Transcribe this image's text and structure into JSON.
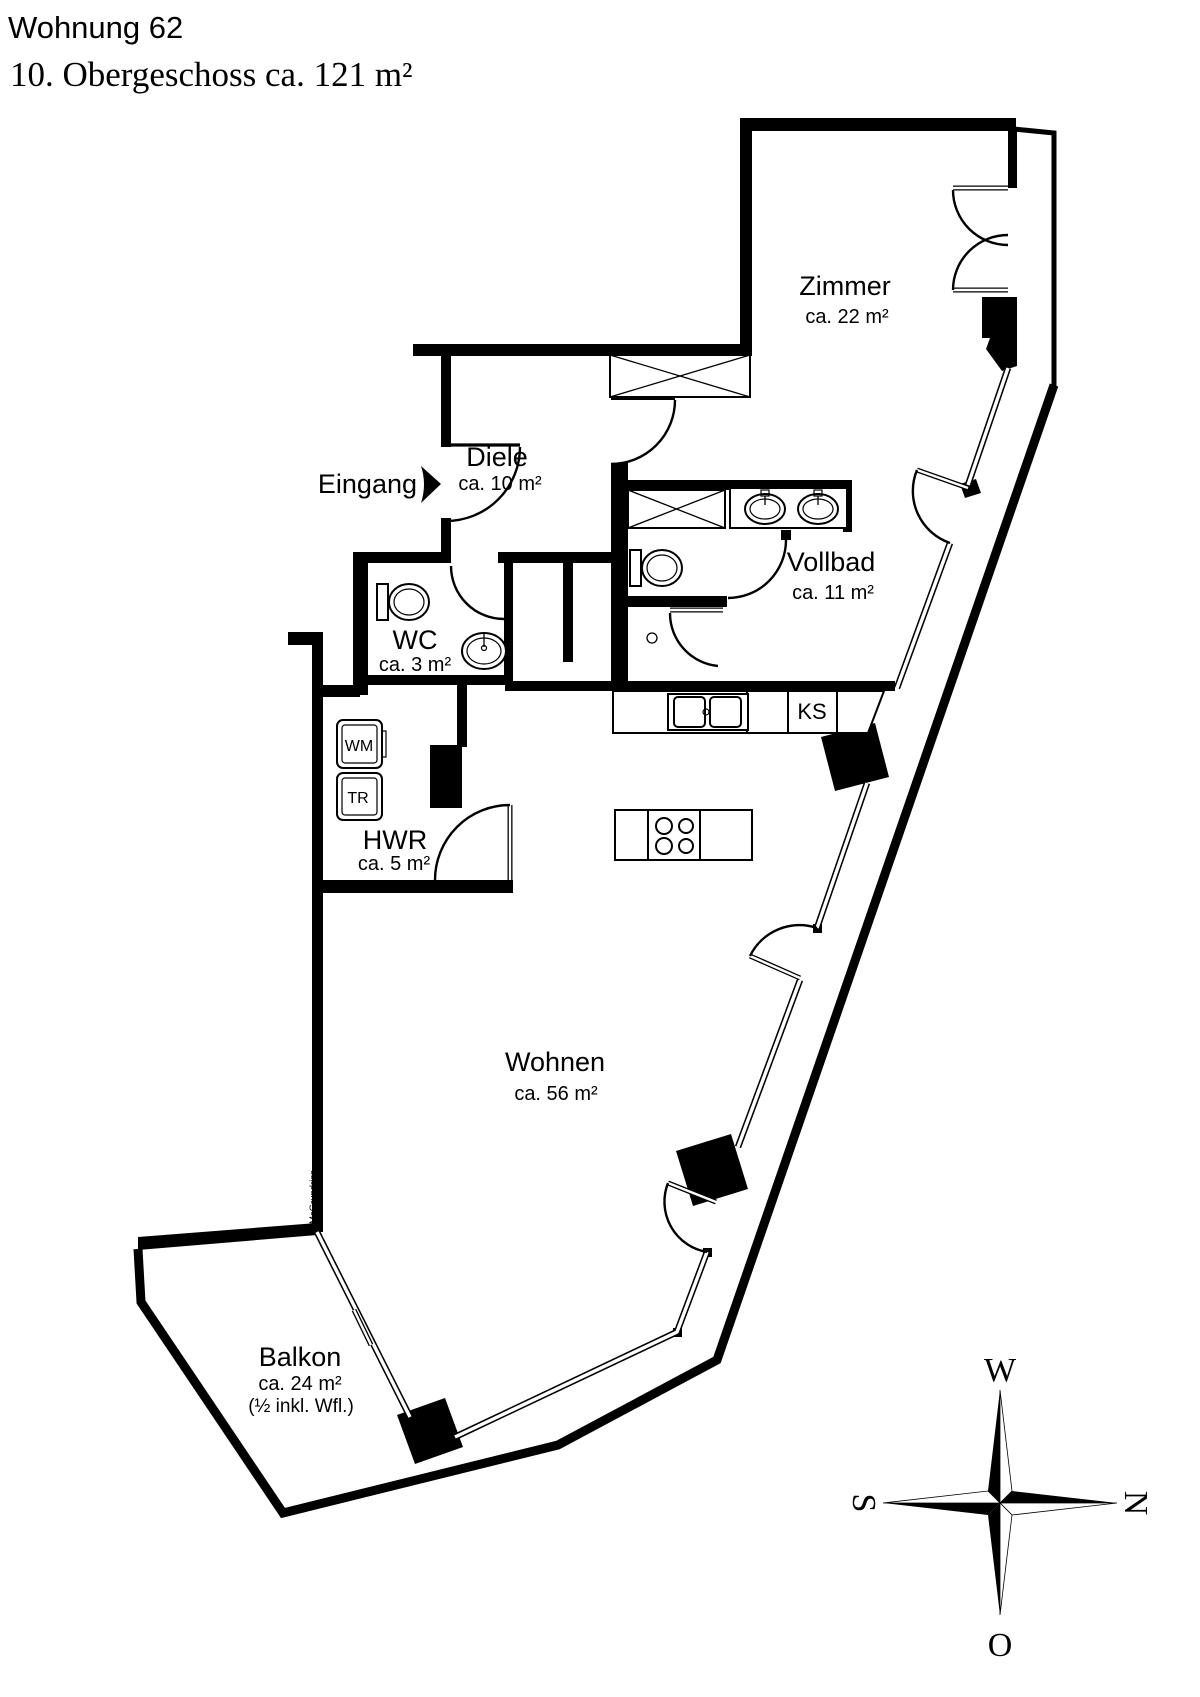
{
  "title": "Wohnung 62",
  "subtitle": "10. Obergeschoss ca. 121 m²",
  "rooms": [
    {
      "id": "zimmer",
      "name": "Zimmer",
      "area": "ca. 22 m²"
    },
    {
      "id": "diele",
      "name": "Diele",
      "area": "ca. 10 m²"
    },
    {
      "id": "vollbad",
      "name": "Vollbad",
      "area": "ca. 11 m²"
    },
    {
      "id": "wc",
      "name": "WC",
      "area": "ca. 3 m²"
    },
    {
      "id": "hwr",
      "name": "HWR",
      "area": "ca. 5 m²"
    },
    {
      "id": "wohnen",
      "name": "Wohnen",
      "area": "ca. 56 m²"
    },
    {
      "id": "balkon",
      "name": "Balkon",
      "area": "ca. 24 m²",
      "note": "(½ inkl. Wfl.)"
    }
  ],
  "labels": {
    "entrance": "Eingang",
    "fridge": "KS",
    "washing_machine": "WM",
    "dryer": "TR",
    "watermark": "McGrundriss"
  },
  "compass": {
    "west": "W",
    "north": "N",
    "south": "S",
    "east": "O"
  },
  "colors": {
    "ink": "#000000",
    "background": "#ffffff",
    "watermark": "#8a8a8a"
  }
}
